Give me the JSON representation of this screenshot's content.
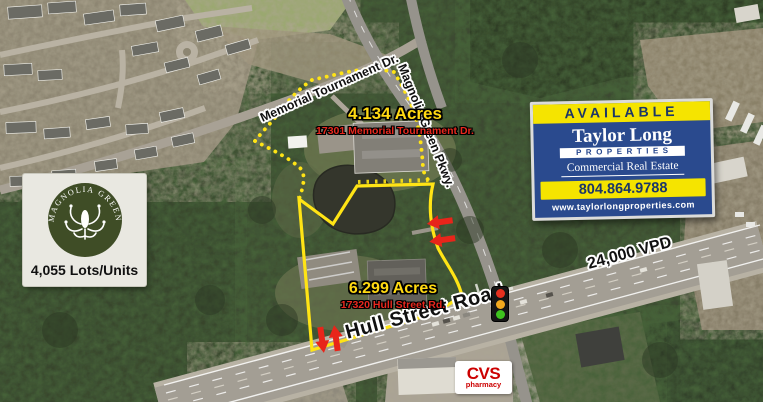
{
  "map_labels": {
    "memorial_road": "Memorial Tournament Dr.",
    "magnolia_road": "Magnolia Green Pkwy.",
    "hull_road": "Hull Street Road",
    "traffic_count": "24,000 VPD"
  },
  "parcels": [
    {
      "acres": "4.134 Acres",
      "address": "17301 Memorial Tournament Dr."
    },
    {
      "acres": "6.299 Acres",
      "address": "17320 Hull Street Rd."
    }
  ],
  "community": {
    "logo_text": "MAGNOLIA GREEN",
    "stat": "4,055 Lots/Units"
  },
  "sign": {
    "banner": "AVAILABLE",
    "company": "Taylor Long",
    "division": "PROPERTIES",
    "tagline": "Commercial Real Estate",
    "phone": "804.864.9788",
    "website": "www.taylorlongproperties.com"
  },
  "poi": {
    "cvs_name": "CVS",
    "cvs_sub": "pharmacy"
  },
  "colors": {
    "boundary_yellow": "#FFE415",
    "acres_yellow": "#FFD912",
    "address_red": "#E8281E",
    "sign_blue": "#2A4A8E",
    "sign_yellow": "#F5E400",
    "sign_navy": "#1B3668",
    "cvs_red": "#CC0000",
    "logo_green": "#3F4D26"
  }
}
